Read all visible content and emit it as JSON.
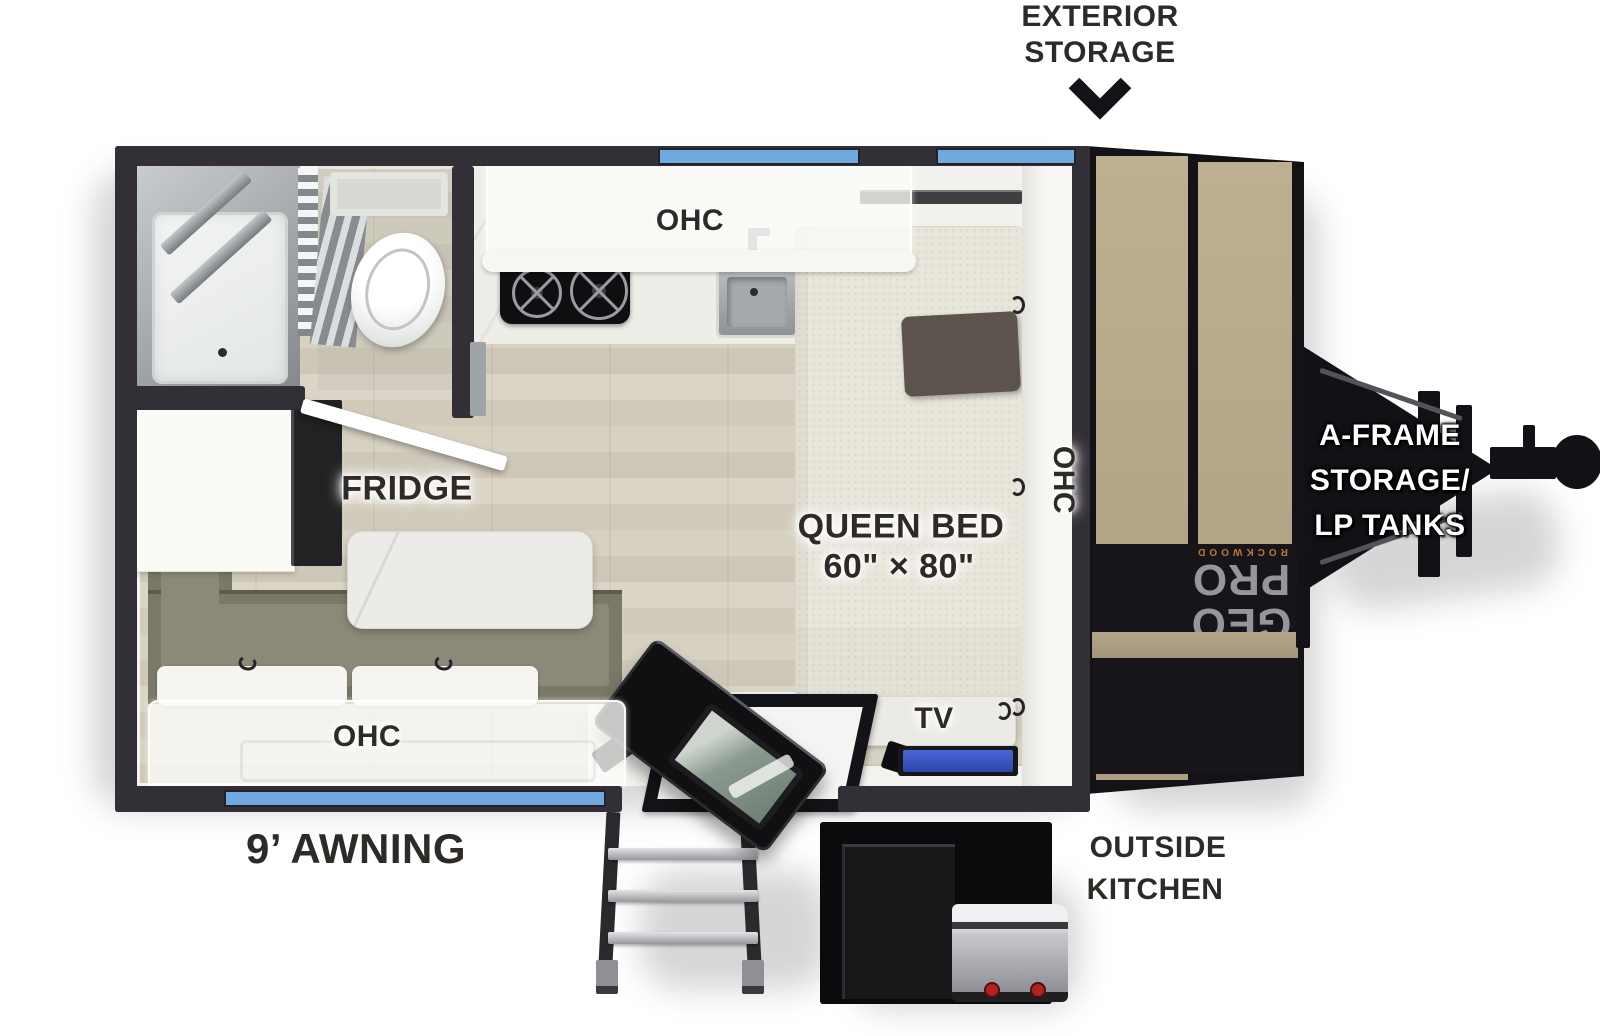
{
  "page": {
    "background": "#ffffff",
    "type": "travel trailer RV floor plan diagram"
  },
  "annotations": {
    "exterior_storage": {
      "line1": "EXTERIOR",
      "line2": "STORAGE",
      "arrow": "chevron-down"
    },
    "a_frame": {
      "line1": "A-FRAME",
      "line2": "STORAGE/",
      "line3": "LP TANKS"
    },
    "outside_kitchen": {
      "line1": "OUTSIDE",
      "line2": "KITCHEN"
    },
    "awning": "9’ AWNING",
    "queen_bed": {
      "line1": "QUEEN BED",
      "line2": "60\" × 80\""
    },
    "fridge": "FRIDGE",
    "tv": "TV",
    "ohc_kitchen": "OHC",
    "ohc_bench": "OHC",
    "ohc_bed_wall": "OHC",
    "front_brand": {
      "small": "ROCKWOOD",
      "large": "GEO PRO"
    }
  },
  "features": [
    "shower",
    "toilet",
    "pleated bath door",
    "refrigerator",
    "dinette bench",
    "dinette table",
    "two-burner cooktop",
    "kitchen sink",
    "queen bed",
    "pillow",
    "flat tv",
    "entry door",
    "fold-out entry steps",
    "outside kitchen griddle",
    "a-frame hitch",
    "lp tank rack",
    "roadside window",
    "front window",
    "curbside awning window"
  ],
  "colors": {
    "window_blue": "#6fa9dd",
    "wall_charcoal": "#332f36",
    "front_cap_tan": "#b6a98a",
    "bench_olive": "#7a7867",
    "tv_screen_blue": "#3c57c6",
    "label_ink": "#2d2a27",
    "brand_gray": "#96969a",
    "brand_orange": "#c0762f",
    "knob_red": "#b32121"
  }
}
